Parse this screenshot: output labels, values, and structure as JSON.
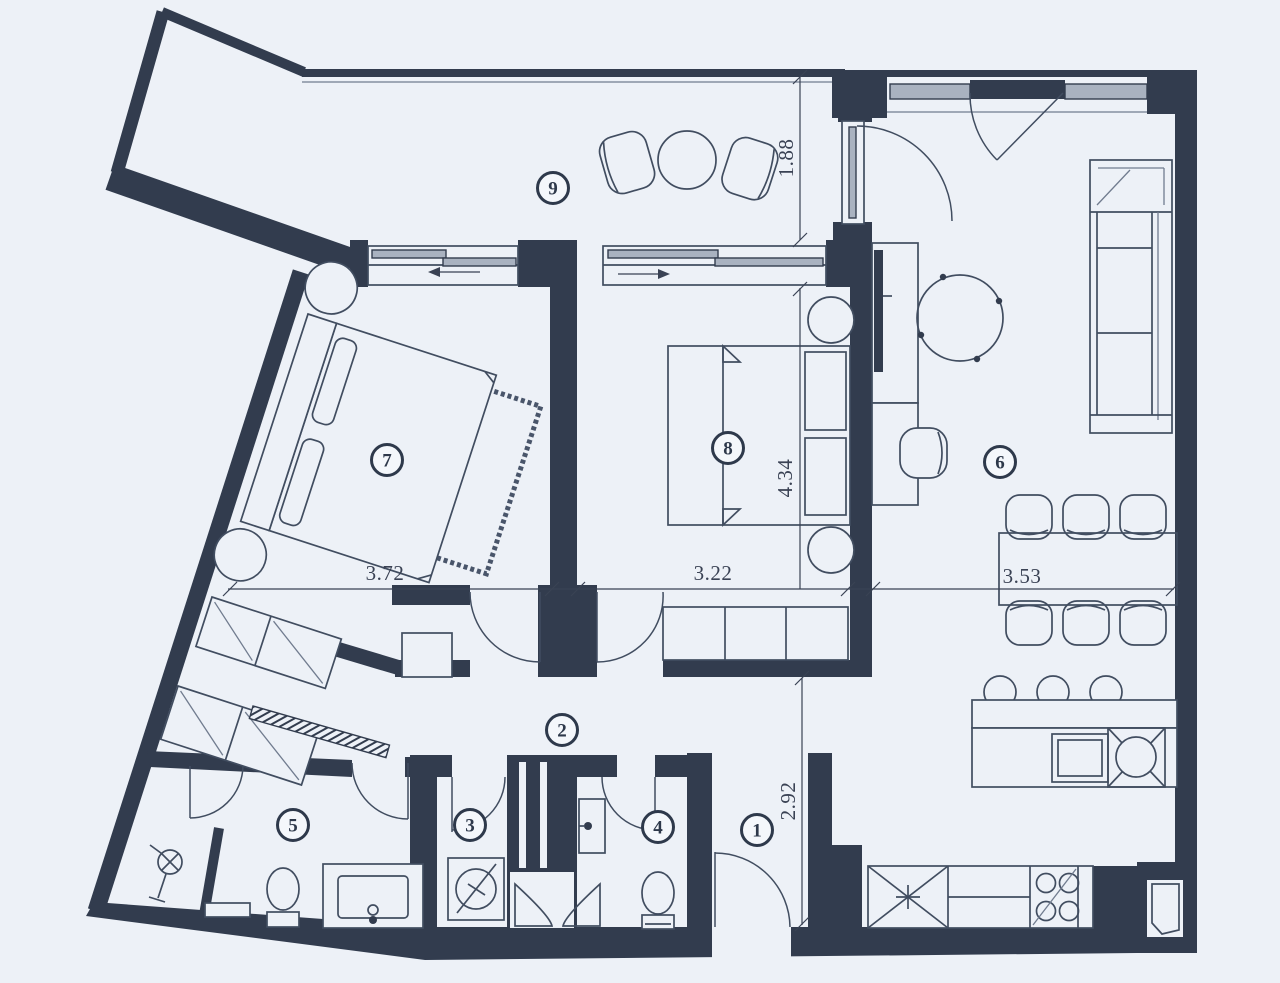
{
  "title": "Apartment floor plan",
  "colors": {
    "background": "#edf1f7",
    "walls": "#323c4e",
    "furniture_lines": "#414d60",
    "glass": "#a9b2c0",
    "text": "#3a4254"
  },
  "rooms": [
    {
      "label": "1"
    },
    {
      "label": "2"
    },
    {
      "label": "3"
    },
    {
      "label": "4"
    },
    {
      "label": "5"
    },
    {
      "label": "6"
    },
    {
      "label": "7"
    },
    {
      "label": "8"
    },
    {
      "label": "9"
    }
  ],
  "dimensions": {
    "bedroom7_width": "3.72",
    "bedroom8_width": "3.22",
    "living_width": "3.53",
    "terrace_depth": "1.88",
    "bedroom8_depth": "4.34",
    "entry_depth": "2.92"
  },
  "icons": [
    "bed-icon",
    "rug-icon",
    "nightstand-icon",
    "wardrobe-icon",
    "sliding-door-icon",
    "sofa-icon",
    "hanging-chair-icon",
    "tv-icon",
    "desk-icon",
    "desk-chair-icon",
    "dining-table-icon",
    "dining-chair-icon",
    "kitchen-island-icon",
    "oven-icon",
    "sink-icon",
    "bar-stool-icon",
    "fridge-icon",
    "cooktop-icon",
    "round-table-icon",
    "terrace-chair-icon",
    "toilet-icon",
    "vanity-sink-icon",
    "shower-icon",
    "washing-machine-icon",
    "wall-sink-icon",
    "door-swing-icon",
    "window-icon",
    "shaft-icon"
  ]
}
